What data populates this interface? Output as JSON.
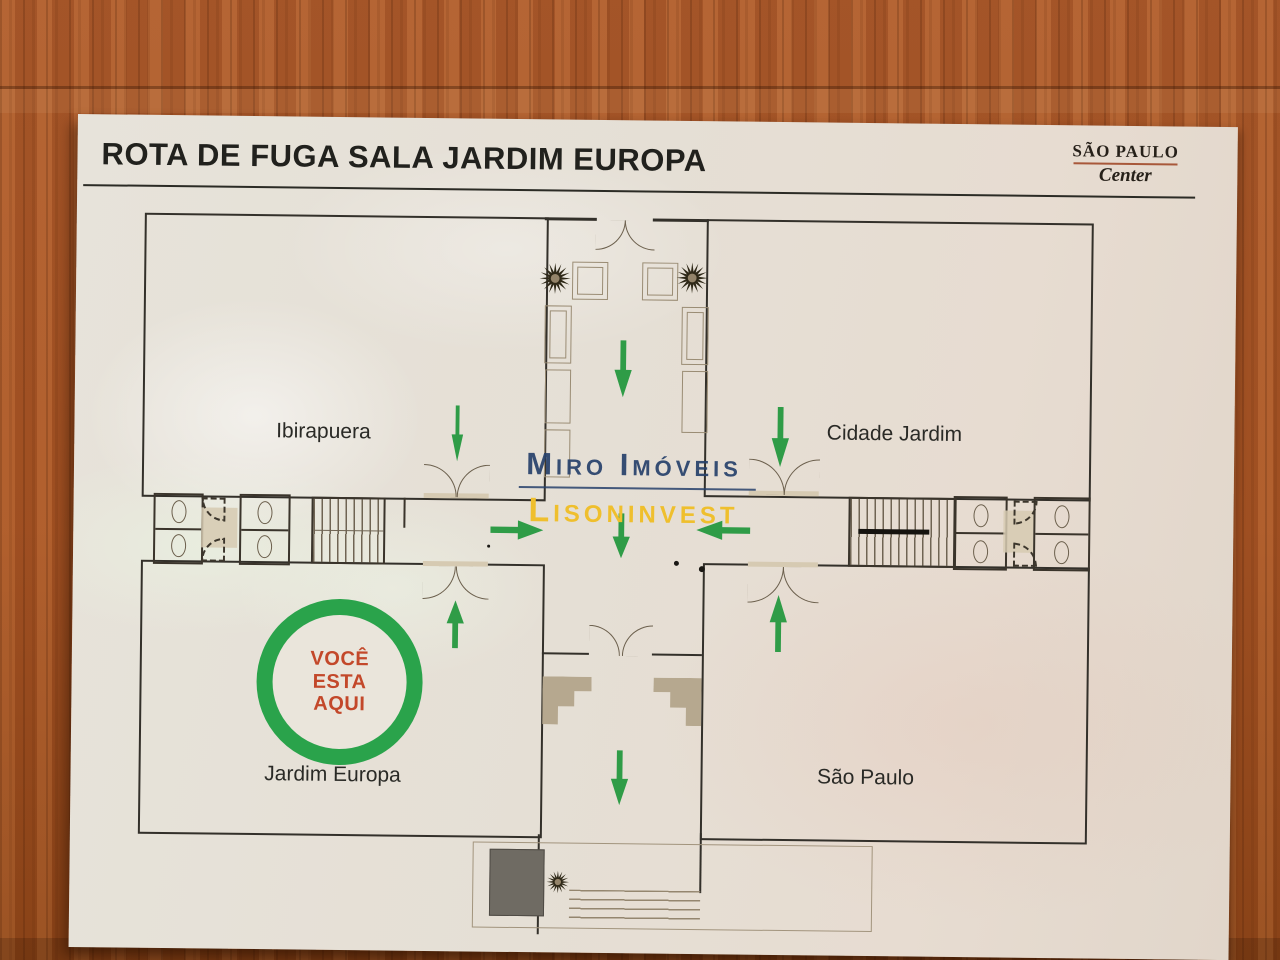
{
  "title": "ROTA DE FUGA SALA JARDIM EUROPA",
  "logo": {
    "name": "SÃO PAULO",
    "subtitle": "Center"
  },
  "rooms": {
    "ibirapuera": "Ibirapuera",
    "cidade_jardim": "Cidade Jardim",
    "jardim_europa": "Jardim Europa",
    "sao_paulo": "São Paulo"
  },
  "you_are_here": {
    "line1": "VOCÊ",
    "line2": "ESTA",
    "line3": "AQUI"
  },
  "watermarks": {
    "primary": "Miro Imóveis",
    "secondary": "Lisoninvest"
  },
  "icons": {
    "plant": "starburst-plant-icon",
    "arrow_down": "arrow-down-icon",
    "arrow_up": "arrow-up-icon",
    "arrow_left": "arrow-left-icon",
    "arrow_right": "arrow-right-icon",
    "elevator": "elevator-symbol",
    "stairs": "stairs-symbol"
  },
  "colors": {
    "arrow_green": "#2f9c47",
    "ring_green": "#2aa34b",
    "you_are_here_text": "#c3482a",
    "watermark_navy": "#27416b",
    "watermark_yellow": "#efbf2d",
    "wood_brown": "#a9572a",
    "board_white": "#e5dfd5",
    "wall_dark": "#33302a"
  }
}
